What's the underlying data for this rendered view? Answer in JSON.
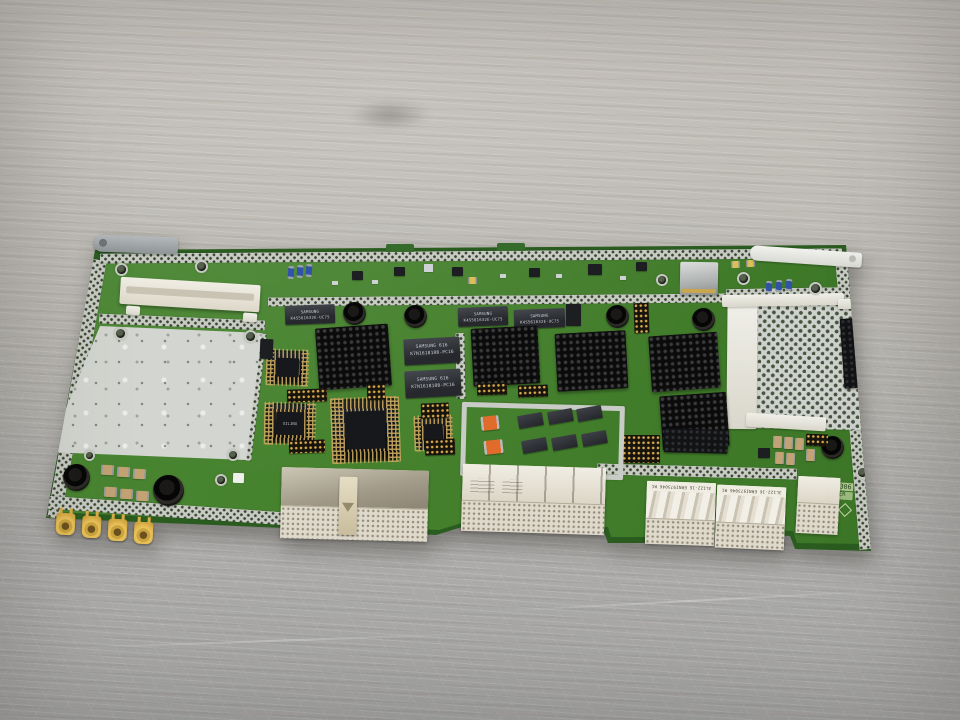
{
  "markings": {
    "part_number": "2110.3306",
    "board_name": "SPE CODER",
    "sdram_line1": "SAMSUNG",
    "sdram_line2": "K4S561632E-UC75",
    "sram_line1": "SAMSUNG 616",
    "sram_line2": "K7N161810B-PC16",
    "cpld_label": "XILINX",
    "erni_label": "3L122-16 ERNI973046 RC"
  },
  "colors": {
    "board_green": "#4a8733",
    "board_green_dark": "#3a7426",
    "board_edge": "#2a5c20",
    "shield_silver": "#d3d6d0",
    "perf_silver": "#c7cbc4",
    "heatsink_black": "#0b0b0b",
    "chip_dark": "#26282d",
    "gold": "#d8a94a",
    "orange_cap": "#e06b2a",
    "blue_comp": "#3052a8",
    "connector_white": "#e9e5da",
    "wood_light": "#c6c2bc",
    "wood_dark": "#a7a7a6"
  }
}
